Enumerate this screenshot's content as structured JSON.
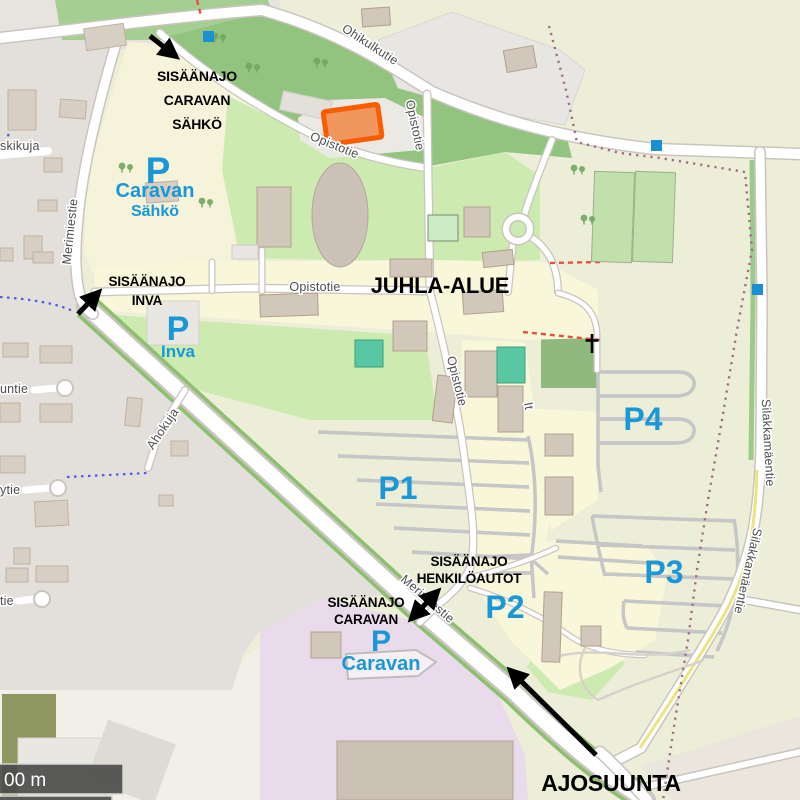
{
  "map": {
    "street_labels": {
      "ohikulkutie": "Ohikulkutie",
      "opistotie": "Opistotie",
      "merimiestie": "Merimiestie",
      "meskikuja": "skikuja",
      "ahokuja": "Ahokuja",
      "silakkamaentie": "Silakkamäentie",
      "untie": "untie",
      "ytie": "ytie",
      "tie": "tie",
      "it": "It"
    },
    "place_labels": {
      "ryttyla": "Ryttylä"
    },
    "scale_bar_label": "00 m",
    "colors": {
      "annotation_blue": "#1a97d6",
      "annotation_black": "#000000",
      "highlight_building_fill": "#f0975f",
      "highlight_building_border": "#fa5d00",
      "marker_blue": "#1a8fd1",
      "woods_green": "#92c47f",
      "grass_green": "#cdebb0",
      "residential_gray": "#e3e0db",
      "retail_pink": "#e9dbeb",
      "campus_yellow": "#f9f7da"
    }
  },
  "annotations": {
    "area": "JUHLA-ALUE",
    "direction": "AJOSUUNTA",
    "entrance_caravan_sahko": [
      "SISÄÄNAJO",
      "CARAVAN",
      "SÄHKÖ"
    ],
    "entrance_inva": [
      "SISÄÄNAJO",
      "INVA"
    ],
    "entrance_henkiloautot": [
      "SISÄÄNAJO",
      "HENKILÖAUTOT"
    ],
    "entrance_caravan": [
      "SISÄÄNAJO",
      "CARAVAN"
    ],
    "parking_caravan_sahko": {
      "p": "P",
      "name": "Caravan",
      "sub": "Sähkö"
    },
    "parking_inva": {
      "p": "P",
      "name": "Inva"
    },
    "parking_caravan": {
      "p": "P",
      "name": "Caravan"
    },
    "p1": "P1",
    "p2": "P2",
    "p3": "P3",
    "p4": "P4"
  }
}
